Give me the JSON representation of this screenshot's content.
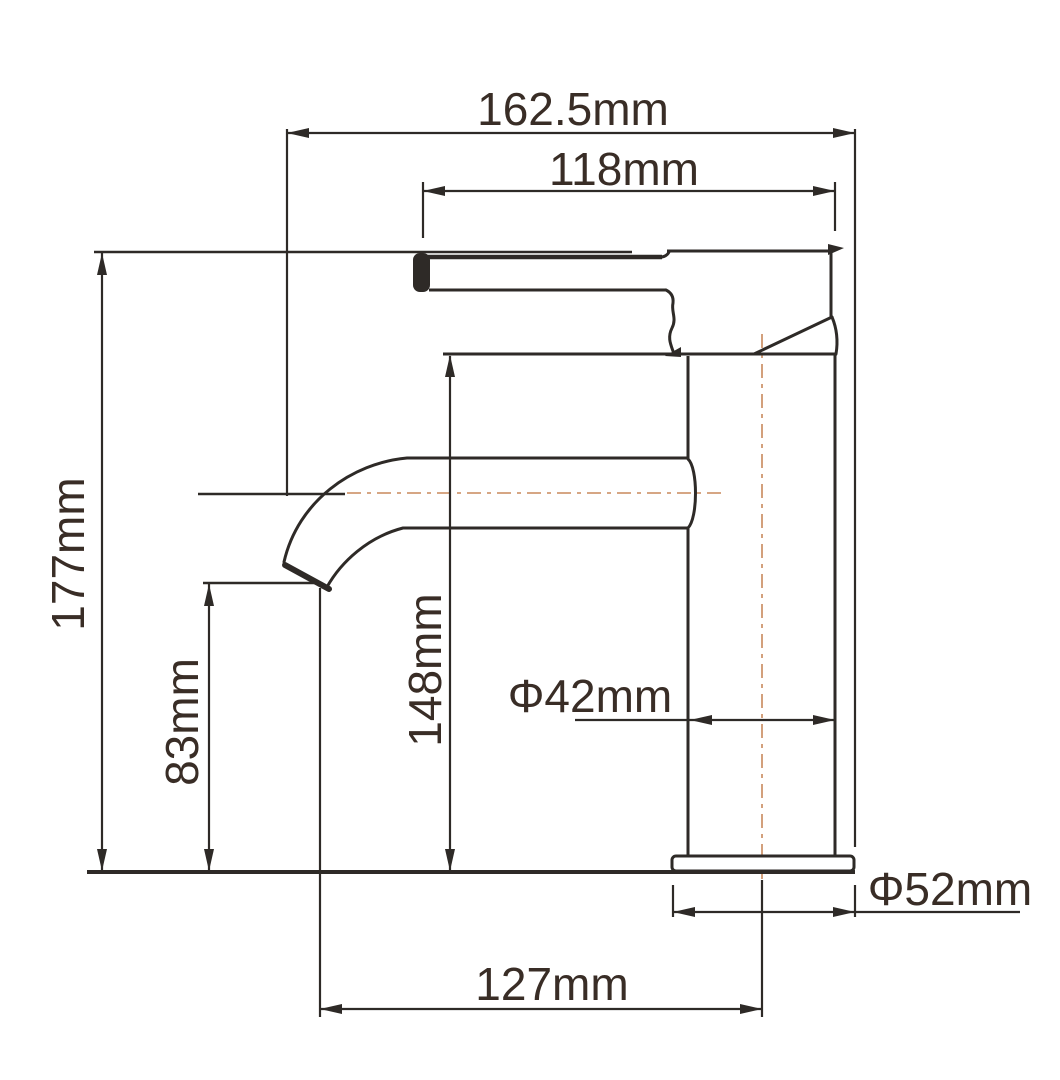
{
  "colors": {
    "ink": "#2e2a27",
    "label": "#392d26",
    "centerline": "#c8895c",
    "background": "#ffffff"
  },
  "labels": {
    "overall_width": "162.5mm",
    "handle_length": "118mm",
    "overall_height": "177mm",
    "spout_outlet_height": "83mm",
    "spout_top_height": "148mm",
    "body_diameter": "Φ42mm",
    "base_diameter": "Φ52mm",
    "spout_reach": "127mm"
  }
}
